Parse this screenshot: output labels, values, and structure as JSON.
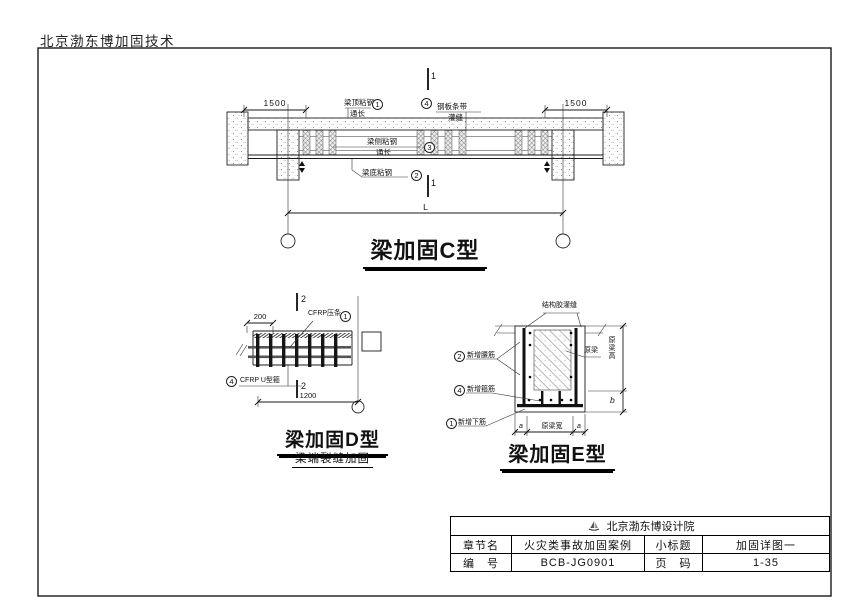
{
  "header": {
    "company_tech": "北京渤东博加固技术"
  },
  "c": {
    "title": "梁加固C型",
    "sec_top": "1",
    "sec_bot": "1",
    "dim_left": "1500",
    "dim_right": "1500",
    "dim_span": "L",
    "lbl1": {
      "n": "1",
      "t1": "梁顶粘钢",
      "t2": "通长"
    },
    "lbl4": {
      "n": "4",
      "t1": "钢板条带",
      "t2": "灌缝"
    },
    "lbl3": {
      "n": "3",
      "t1": "梁侧粘钢",
      "t2": "通长"
    },
    "lbl2": {
      "n": "2",
      "t1": "梁底粘钢"
    }
  },
  "d": {
    "title": "梁加固D型",
    "subtitle": "梁端裂缝加固",
    "sec_top": "2",
    "sec_bot": "2",
    "dim_top": "200",
    "dim_bottom": "1200",
    "lbl1": {
      "n": "1",
      "t": "CFRP压条"
    },
    "lbl4": {
      "n": "4",
      "t": "CFRP U型箍"
    }
  },
  "e": {
    "title": "梁加固E型",
    "lbl_adhesive": "结构胶灌缝",
    "lbl2": {
      "n": "2",
      "t": "新增腰筋"
    },
    "lbl4": {
      "n": "4",
      "t": "新增箍筋"
    },
    "lbl1": {
      "n": "1",
      "t": "新增下筋"
    },
    "lbl_orig": "原梁",
    "dim_h": "原梁高",
    "dim_b": "b",
    "dim_a1": "a",
    "dim_w": "原梁宽",
    "dim_a2": "a"
  },
  "titleblock": {
    "company": "北京渤东博设计院",
    "r2c1": "章节名",
    "r2c2": "火灾类事故加固案例",
    "r2c3": "小标题",
    "r2c4": "加固详图一",
    "r3c1": "编　号",
    "r3c2": "BCB-JG0901",
    "r3c3": "页　码",
    "r3c4": "1-35"
  }
}
